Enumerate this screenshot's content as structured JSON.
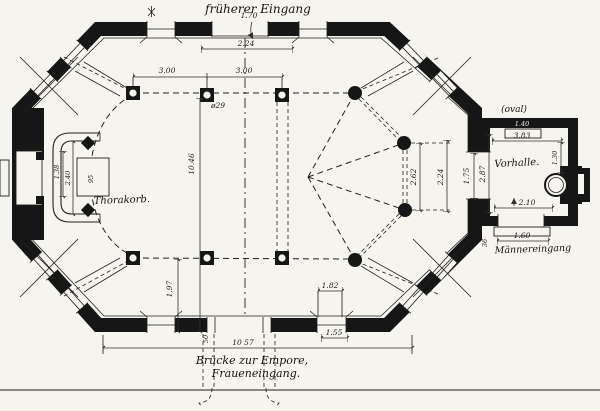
{
  "drawing": {
    "labels": {
      "former_entrance": "früherer Eingang",
      "oval": "(oval)",
      "vorhalle": "Vorhalle.",
      "thorakorb": "Thorakorb.",
      "maennereingang": "Männereingang",
      "bridge1": "Brücke zur Empore,",
      "bridge2": "Fraueneingang."
    },
    "dims": {
      "top_door": "1.70",
      "top_width": "2.24",
      "bay_left": "3.00",
      "bay_right": "3.00",
      "col_dia": "ø29",
      "hall_length": "10.46",
      "fan_spacing": "2.62",
      "fan_wall": "2.24",
      "door_east": "1.75",
      "vorhalle_depth": "2.87",
      "vorhalle_width": "3.83",
      "vorhalle_window": "1.40",
      "vorhalle_right": "1.30",
      "exit_width": "2.10",
      "step_width": "1.60",
      "apse_inner": "1.38",
      "apse_outer": "2.40",
      "bima_width": "95",
      "sw_bay": "1.97",
      "window_inner": "1.82",
      "window_outer": "1.55",
      "total_width": "10 57",
      "step_mark": "50",
      "annex_mark": "36"
    }
  }
}
